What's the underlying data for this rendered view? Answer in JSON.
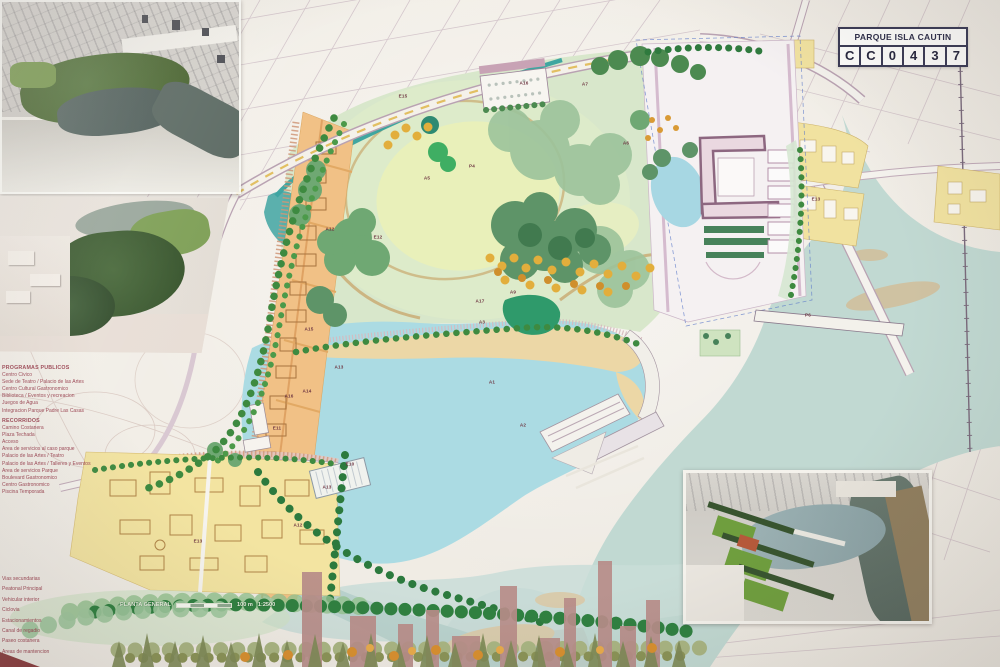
{
  "poster": {
    "title_block": {
      "title": "PARQUE ISLA CAUTIN",
      "code": "CC0437",
      "code_cells": [
        "C",
        "C",
        "0",
        "4",
        "3",
        "7"
      ]
    },
    "drawing": {
      "name": "PLANTA GENERAL",
      "scale_distance": "100 m",
      "scale_ratio": "1:2500"
    },
    "legend": {
      "section_buildings": {
        "header": "PROGRAMAS PUBLICOS",
        "items": [
          "Centro Civico",
          "Sede de Teatro / Palacio de las Artes",
          "Centro Cultural Gastronomico",
          "Biblioteca / Eventos y recreacion",
          "Juegos de Agua",
          "Integracion Parque Padre Las Casas"
        ]
      },
      "section_program": {
        "header": "RECORRIDOS",
        "items": [
          "Camino Costanera",
          "Plaza Techada",
          "Acceso",
          "Area de servicios al caso parque",
          "Palacio de las Artes / Teatro",
          "Palacio de las Artes / Talleres y Eventos",
          "Area de servicios Parque",
          "Boulevard Gastronomico",
          "Centro Gastronomico",
          "Piscina Temporada"
        ]
      },
      "section_circulation": {
        "items": [
          "Vias secundarias",
          "Peatonal Principal",
          "Vehicular interior",
          "Ciclovia",
          "Estacionamientos",
          "Canal de regadio",
          "Paseo costanera",
          "Areas de mantencion"
        ]
      }
    },
    "plan_labels": [
      {
        "text": "E15",
        "x": 403,
        "y": 96
      },
      {
        "text": "A16",
        "x": 524,
        "y": 83
      },
      {
        "text": "A7",
        "x": 585,
        "y": 84
      },
      {
        "text": "A6",
        "x": 626,
        "y": 143
      },
      {
        "text": "P4",
        "x": 472,
        "y": 166
      },
      {
        "text": "A5",
        "x": 427,
        "y": 178
      },
      {
        "text": "E12",
        "x": 378,
        "y": 237
      },
      {
        "text": "A12",
        "x": 330,
        "y": 229
      },
      {
        "text": "A15",
        "x": 309,
        "y": 329
      },
      {
        "text": "A13",
        "x": 339,
        "y": 367
      },
      {
        "text": "A14",
        "x": 307,
        "y": 391
      },
      {
        "text": "A16",
        "x": 289,
        "y": 396
      },
      {
        "text": "E11",
        "x": 277,
        "y": 428
      },
      {
        "text": "E10",
        "x": 350,
        "y": 464
      },
      {
        "text": "A13",
        "x": 327,
        "y": 487
      },
      {
        "text": "A12",
        "x": 298,
        "y": 525
      },
      {
        "text": "E13",
        "x": 198,
        "y": 541
      },
      {
        "text": "A9",
        "x": 513,
        "y": 292
      },
      {
        "text": "A17",
        "x": 480,
        "y": 301
      },
      {
        "text": "A3",
        "x": 482,
        "y": 322
      },
      {
        "text": "A1",
        "x": 492,
        "y": 382
      },
      {
        "text": "A2",
        "x": 523,
        "y": 425
      },
      {
        "text": "P6",
        "x": 808,
        "y": 315
      },
      {
        "text": "E13",
        "x": 816,
        "y": 199
      }
    ],
    "insets": [
      {
        "name": "aerial-rendering-overview"
      },
      {
        "name": "aerial-rendering-park-detail"
      },
      {
        "name": "aerial-rendering-lagoon"
      }
    ],
    "colors": {
      "lagoon": "#abdbe3",
      "river": "#c1d9d2",
      "park_green": "#d8e7cb",
      "meadow": "#e9f0ba",
      "beach_sand": "#ecd7a6",
      "urban_strip": "#f1c186",
      "residential_yellow": "#f3e4a1",
      "legend_text": "#9c4452",
      "cadastral_line": "#b79fb0",
      "building_mauve": "#ead8e0"
    }
  }
}
